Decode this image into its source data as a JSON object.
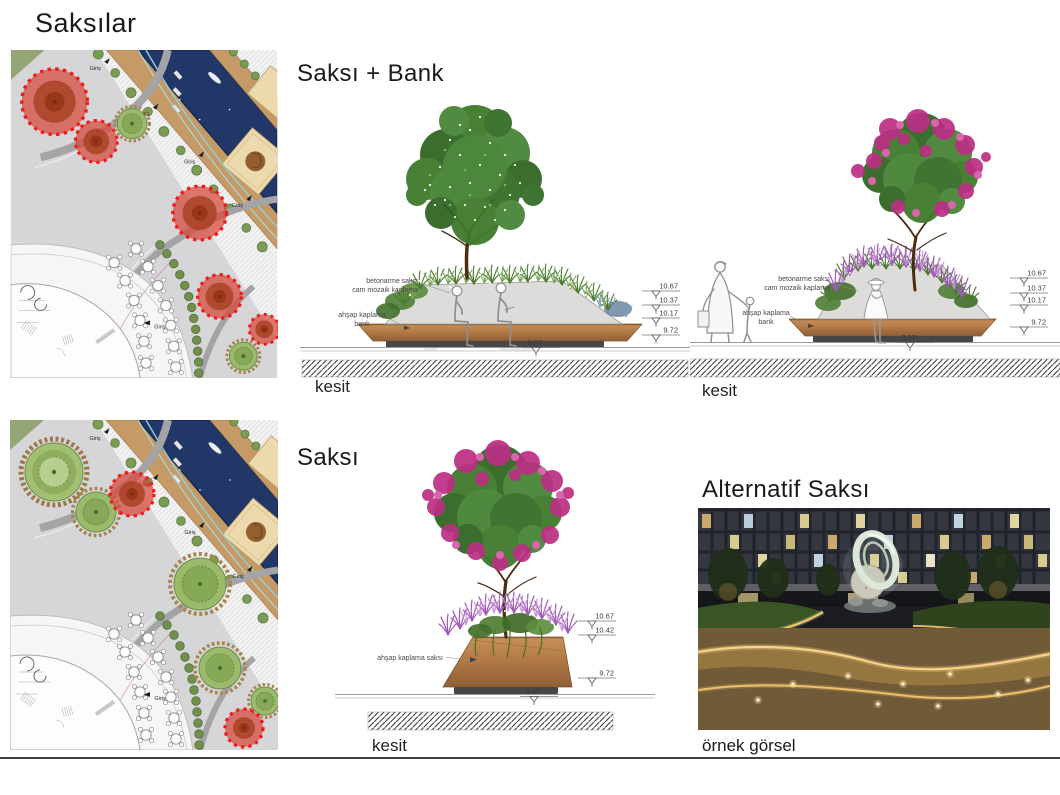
{
  "title": "Saksılar",
  "sections": {
    "saksi_bank": {
      "heading": "Saksı + Bank",
      "kesit_left": "kesit",
      "kesit_right": "kesit"
    },
    "saksi": {
      "heading": "Saksı",
      "kesit": "kesit"
    },
    "alternatif": {
      "heading": "Alternatif Saksı",
      "caption": "örnek görsel"
    }
  },
  "plan": {
    "giris_label": "Giriş"
  },
  "annotations": {
    "concrete_planter_line1": "betonarme saksı",
    "concrete_planter_line2": "cam mozaik kaplama",
    "wood_bench_line1": "ahşap kaplama",
    "wood_bench_line2": "bank",
    "wood_planter": "ahşap kaplama saksı"
  },
  "elevations": {
    "bank_left": [
      "10.67",
      "10.37",
      "10.17",
      "9.72",
      "9.37"
    ],
    "bank_right": [
      "10.67",
      "10.37",
      "10.17",
      "9.72",
      "9.37"
    ],
    "saksi": [
      "10.67",
      "10.42",
      "9.72",
      "9.37"
    ]
  },
  "watermark": "PD",
  "colors": {
    "highlight_red": "#ee1a1a",
    "planter_green": "#9cba6b",
    "wood_brown": "#b07845",
    "pool_blue": "#203768",
    "teal_line": "#8fd2d8"
  }
}
